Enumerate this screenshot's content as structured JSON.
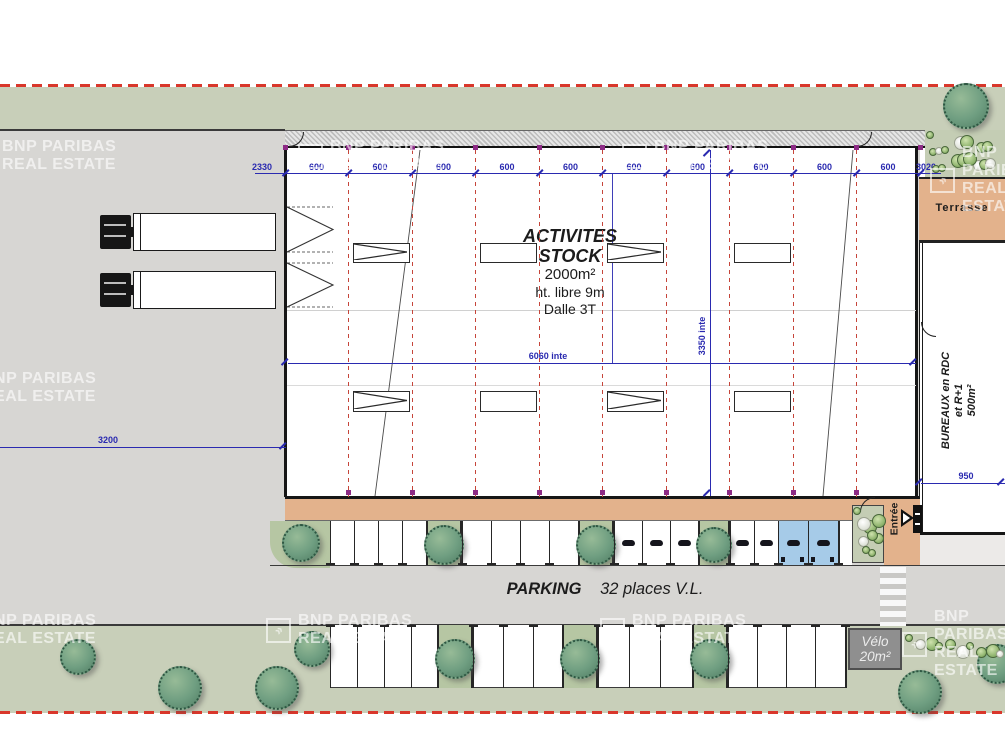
{
  "document": {
    "type": "site-plan"
  },
  "watermark": {
    "line1": "BNP PARIBAS",
    "line2": "REAL ESTATE"
  },
  "building": {
    "title_lines": [
      "ACTIVITES",
      "STOCK"
    ],
    "area": "2000m²",
    "clear_height": "ht. libre 9m",
    "slab": "Dalle 3T"
  },
  "offices": {
    "lines": [
      "BUREAUX en RDC",
      "et R+1",
      "500m²"
    ]
  },
  "terrace": {
    "label": "Terrasse"
  },
  "entrance": {
    "label": "Entrée"
  },
  "parking": {
    "title": "PARKING",
    "capacity": "32 places V.L."
  },
  "bike_shed": {
    "lines": [
      "Vélo",
      "20m²"
    ]
  },
  "dimensions": {
    "top_chain": [
      "2330",
      "600",
      "600",
      "600",
      "600",
      "600",
      "600",
      "600",
      "600",
      "600",
      "600",
      "3020"
    ],
    "left_setback": "3200",
    "interior_width": "6060 inte",
    "interior_depth": "3350 inte",
    "office_depth": "950"
  },
  "colors": {
    "boundary_red": "#d9372b",
    "grid_red": "#c6453a",
    "dimension_blue": "#2a2ab0",
    "green_area": "#c8cfb9",
    "tarmac_gray": "#d7d6d3",
    "walkway_tan": "#e3b28c",
    "pmr_blue": "#a6cbe8",
    "tree_green": "#6f9e81"
  },
  "plan": {
    "grid_x": [
      348,
      412,
      475,
      539,
      602,
      666,
      729,
      793,
      856
    ],
    "tick_x": [
      285,
      348,
      412,
      475,
      539,
      602,
      666,
      729,
      793,
      856,
      920
    ],
    "bays": [
      {
        "x": 353,
        "y": 243,
        "w": 57,
        "h": 20,
        "marker": "chevron"
      },
      {
        "x": 480,
        "y": 243,
        "w": 57,
        "h": 20,
        "marker": "plain"
      },
      {
        "x": 607,
        "y": 243,
        "w": 57,
        "h": 20,
        "marker": "chevron"
      },
      {
        "x": 734,
        "y": 243,
        "w": 57,
        "h": 20,
        "marker": "plain"
      },
      {
        "x": 353,
        "y": 391,
        "w": 57,
        "h": 21,
        "marker": "chevron"
      },
      {
        "x": 480,
        "y": 391,
        "w": 57,
        "h": 21,
        "marker": "plain"
      },
      {
        "x": 607,
        "y": 391,
        "w": 57,
        "h": 21,
        "marker": "chevron"
      },
      {
        "x": 734,
        "y": 391,
        "w": 57,
        "h": 21,
        "marker": "plain"
      }
    ],
    "upper_row": {
      "y": 521,
      "h": 44,
      "end": 838,
      "cells": [
        {
          "x": 330,
          "w": 24,
          "t": "stall"
        },
        {
          "x": 354,
          "w": 24,
          "t": "stall"
        },
        {
          "x": 378,
          "w": 24,
          "t": "stall"
        },
        {
          "x": 402,
          "w": 24,
          "t": "stall"
        },
        {
          "x": 426,
          "w": 36,
          "t": "tree"
        },
        {
          "x": 462,
          "w": 29,
          "t": "stall"
        },
        {
          "x": 491,
          "w": 29,
          "t": "stall"
        },
        {
          "x": 520,
          "w": 29,
          "t": "stall"
        },
        {
          "x": 549,
          "w": 29,
          "t": "stall"
        },
        {
          "x": 578,
          "w": 36,
          "t": "tree"
        },
        {
          "x": 614,
          "w": 28,
          "t": "stallg"
        },
        {
          "x": 642,
          "w": 28,
          "t": "stallg"
        },
        {
          "x": 670,
          "w": 28,
          "t": "stallg"
        },
        {
          "x": 698,
          "w": 32,
          "t": "tree"
        },
        {
          "x": 730,
          "w": 24,
          "t": "stallg"
        },
        {
          "x": 754,
          "w": 24,
          "t": "stallg"
        },
        {
          "x": 778,
          "w": 30,
          "t": "blue"
        },
        {
          "x": 808,
          "w": 30,
          "t": "blue"
        }
      ]
    },
    "lower_row": {
      "y": 625,
      "h": 63,
      "end": 845,
      "cells": [
        {
          "x": 330,
          "w": 27,
          "t": "stall"
        },
        {
          "x": 357,
          "w": 27,
          "t": "stall"
        },
        {
          "x": 384,
          "w": 27,
          "t": "stall"
        },
        {
          "x": 411,
          "w": 26,
          "t": "stall"
        },
        {
          "x": 437,
          "w": 36,
          "t": "tree"
        },
        {
          "x": 473,
          "w": 30,
          "t": "stall"
        },
        {
          "x": 503,
          "w": 30,
          "t": "stall"
        },
        {
          "x": 533,
          "w": 29,
          "t": "stall"
        },
        {
          "x": 562,
          "w": 36,
          "t": "tree"
        },
        {
          "x": 598,
          "w": 31,
          "t": "stall"
        },
        {
          "x": 629,
          "w": 31,
          "t": "stall"
        },
        {
          "x": 660,
          "w": 32,
          "t": "stall"
        },
        {
          "x": 692,
          "w": 36,
          "t": "tree"
        },
        {
          "x": 728,
          "w": 29,
          "t": "stall"
        },
        {
          "x": 757,
          "w": 29,
          "t": "stall"
        },
        {
          "x": 786,
          "w": 29,
          "t": "stall"
        },
        {
          "x": 815,
          "w": 30,
          "t": "stall"
        }
      ]
    },
    "trees": [
      {
        "x": 943,
        "y": 83,
        "d": 46
      },
      {
        "x": 60,
        "y": 639,
        "d": 36
      },
      {
        "x": 158,
        "y": 666,
        "d": 44
      },
      {
        "x": 255,
        "y": 666,
        "d": 44
      },
      {
        "x": 294,
        "y": 631,
        "d": 36
      },
      {
        "x": 898,
        "y": 670,
        "d": 44
      },
      {
        "x": 977,
        "y": 644,
        "d": 40
      }
    ],
    "trucks_y": [
      213,
      271
    ],
    "watermarks": [
      {
        "x": 2,
        "y": 138,
        "logo": false
      },
      {
        "x": 298,
        "y": 138,
        "logo": true
      },
      {
        "x": 622,
        "y": 138,
        "logo": true
      },
      {
        "x": 930,
        "y": 144,
        "logo": true
      },
      {
        "x": -18,
        "y": 370,
        "logo": false
      },
      {
        "x": -18,
        "y": 612,
        "logo": false
      },
      {
        "x": 266,
        "y": 612,
        "logo": true
      },
      {
        "x": 600,
        "y": 612,
        "logo": true
      },
      {
        "x": 902,
        "y": 608,
        "logo": true
      }
    ],
    "bush_bands": [
      {
        "x": 926,
        "y": 131,
        "w": 78,
        "h": 45,
        "n": 16,
        "row": false
      },
      {
        "x": 853,
        "y": 507,
        "w": 30,
        "h": 55,
        "n": 9,
        "row": false
      },
      {
        "x": 905,
        "y": 634,
        "w": 100,
        "h": 24,
        "n": 10,
        "row": true
      }
    ],
    "slashes": [
      [
        282,
        445
      ],
      [
        284,
        361
      ],
      [
        912,
        361
      ],
      [
        918,
        481
      ],
      [
        1000,
        481
      ],
      [
        706,
        152
      ],
      [
        706,
        492
      ]
    ]
  }
}
